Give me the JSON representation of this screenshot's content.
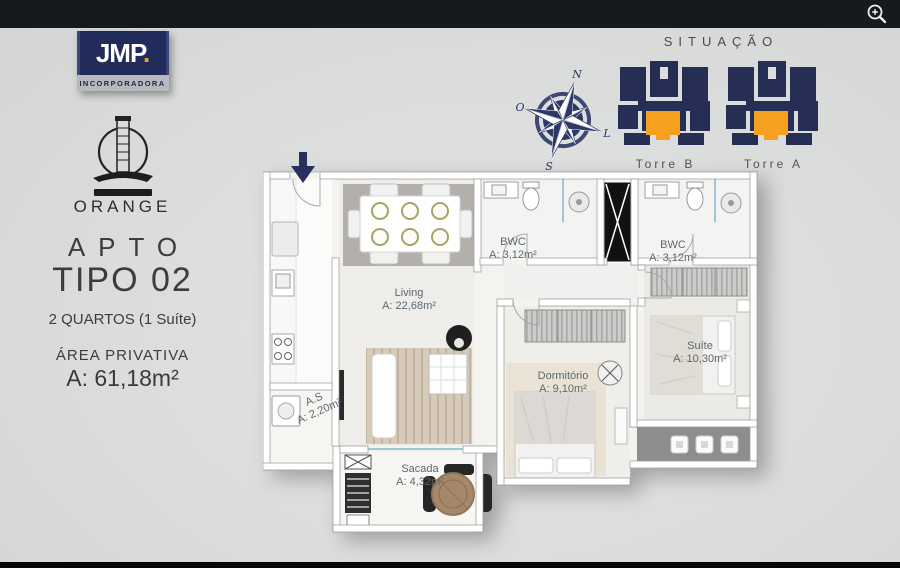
{
  "chrome": {
    "zoom_icon": "zoom-in-magnifier",
    "top_bar_color": "#16191d",
    "bottom_bar_color": "#060606",
    "background_color": "#dcdddd"
  },
  "branding": {
    "logo_text": "JMP",
    "logo_dot": ".",
    "logo_subtext": "INCORPORADORA",
    "logo_bg_color": "#212c5b",
    "logo_accent_color": "#f6a01f",
    "project_name": "ORANGE",
    "project_icon": "lighthouse-tower"
  },
  "unit": {
    "label": "APTO",
    "type": "TIPO 02",
    "rooms_line": "2 QUARTOS (1 Suíte)",
    "area_label": "ÁREA PRIVATIVA",
    "area_value": "A: 61,18m²"
  },
  "situacao": {
    "title": "SITUAÇÃO",
    "navy_color": "#262e55",
    "highlight_color": "#f6a01f",
    "towers": [
      {
        "label": "Torre B"
      },
      {
        "label": "Torre A"
      }
    ]
  },
  "compass": {
    "n": "N",
    "o": "O",
    "l": "L",
    "s": "S"
  },
  "floorplan": {
    "label_color": "#5b6970",
    "rooms": [
      {
        "name": "BWC",
        "area": "A: 3,12m²"
      },
      {
        "name": "BWC",
        "area": "A: 3,12m²"
      },
      {
        "name": "Living",
        "area": "A: 22,68m²"
      },
      {
        "name": "Dormitório",
        "area": "A: 9,10m²"
      },
      {
        "name": "Suíte",
        "area": "A: 10,30m²"
      },
      {
        "name": "A.S",
        "area": "A: 2,20m²"
      },
      {
        "name": "Sacada",
        "area": "A: 4,32m²"
      }
    ]
  }
}
